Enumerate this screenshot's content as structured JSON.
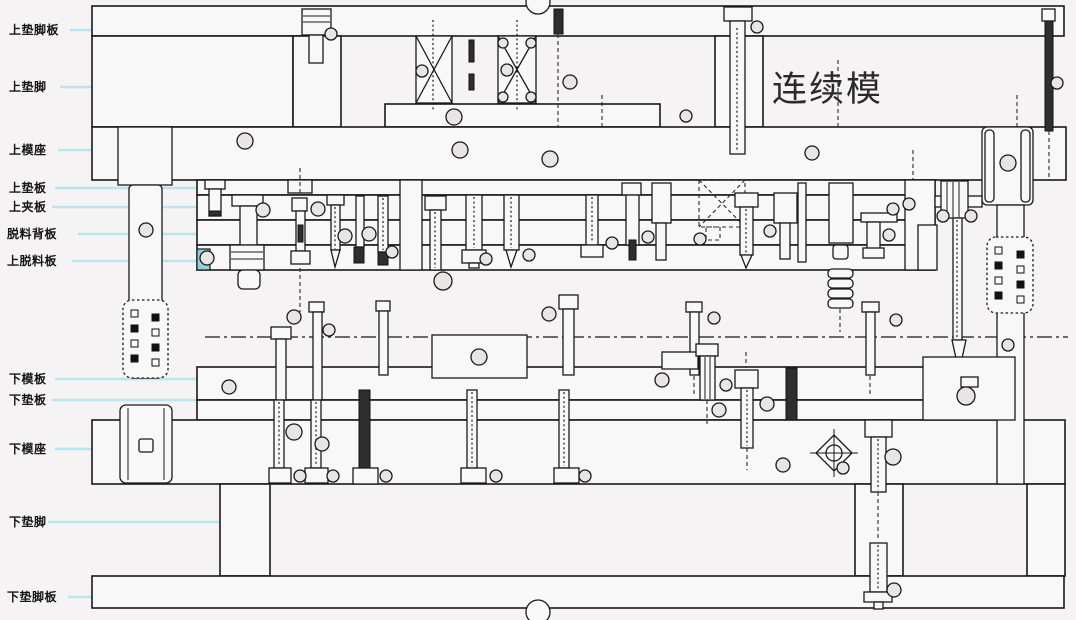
{
  "title": {
    "text": "连续模"
  },
  "labels": [
    "上垫脚板",
    "上垫脚",
    "上模座",
    "上垫板",
    "上夹板",
    "脱料背板",
    "上脱料板",
    "下模板",
    "下垫板",
    "下模座",
    "下垫脚",
    "下垫脚板"
  ],
  "colors": {
    "line": "#1a1a1a",
    "leader_line": "#b9e5ef",
    "background": "#f5f3f4",
    "teal_insert": "#8ed2da"
  }
}
